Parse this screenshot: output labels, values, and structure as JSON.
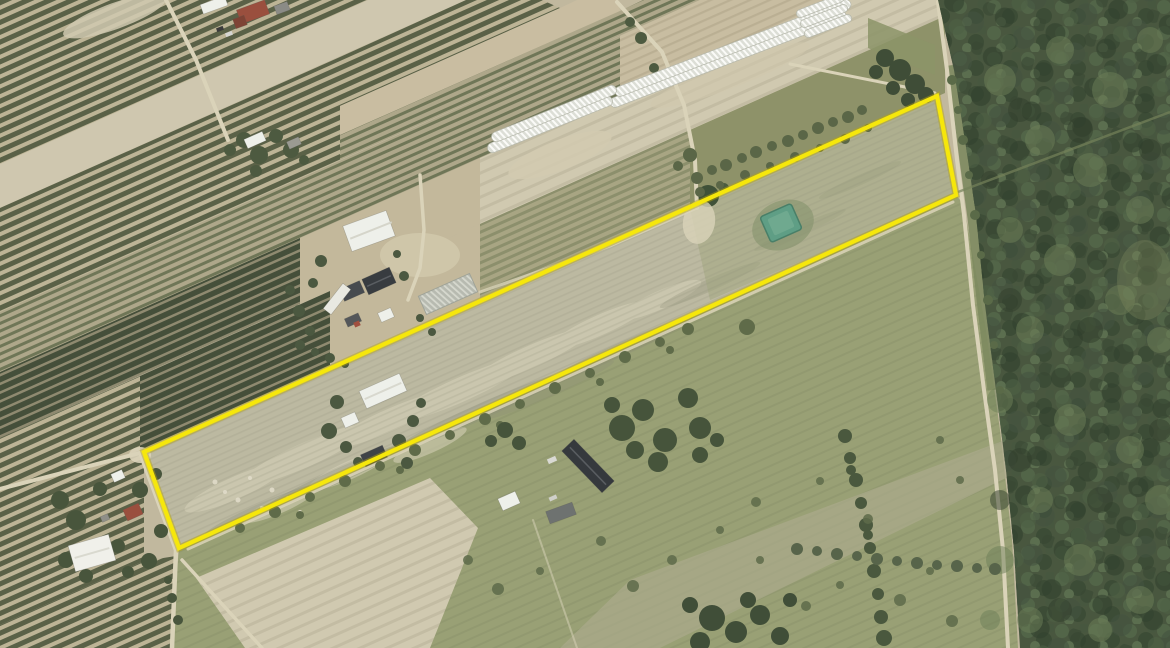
{
  "scene": {
    "kind": "aerial orthophoto of farmland with a long narrow parcel outlined in yellow",
    "visible_text": "none"
  },
  "colors": {
    "base": "#c1b89e",
    "orchard_dark": "#5a6147",
    "orchard_light": "#bdb496",
    "dense_dark": "#454f3a",
    "dense_light": "#8f8a70",
    "vine_dark": "#6f7657",
    "vine_light": "#aea78a",
    "tan": "#c9bda1",
    "tan_row": "#b9ae92",
    "pale": "#d0c9b0",
    "pale_row": "#c3bca3",
    "dirt": "#c3b89b",
    "road": "#dad3b9",
    "parcel_fill": "#bcb9a1",
    "parcel_streak": "#8e8f79",
    "meadow": "#99a075",
    "meadow_light": "#abaa8b",
    "belt_green": "#8e9269",
    "green_rows": "#a3a47e",
    "forest_base": "#49573f",
    "forest_light": "#6d7f58",
    "forest_dark": "#313e2c",
    "clearing": "#7d8a5f",
    "tree_dark": "#46543b",
    "bush": "#5e6b4a",
    "tunnel_bg": "#dcded6",
    "tunnel_rib": "#fbfbf8",
    "glass_bg": "#b7bab0",
    "glass_rib": "#d6d8ce",
    "white_roof": "#eef0ea",
    "barn_dark": "#383c40",
    "gray_roof": "#6e7270",
    "roof_red": "#9a4f3e",
    "pond": "#5f9e85",
    "pond_edge": "#497f68",
    "outline": "#f6e70b",
    "outline_under": "#b7a60b"
  },
  "parcel": {
    "points": "144,452 937,96 956,195 179,548",
    "outline_width": 4.2
  },
  "pond": {
    "x": 764,
    "y": 209,
    "w": 34,
    "h": 28,
    "transform": "rotate(-24 781 223)"
  }
}
